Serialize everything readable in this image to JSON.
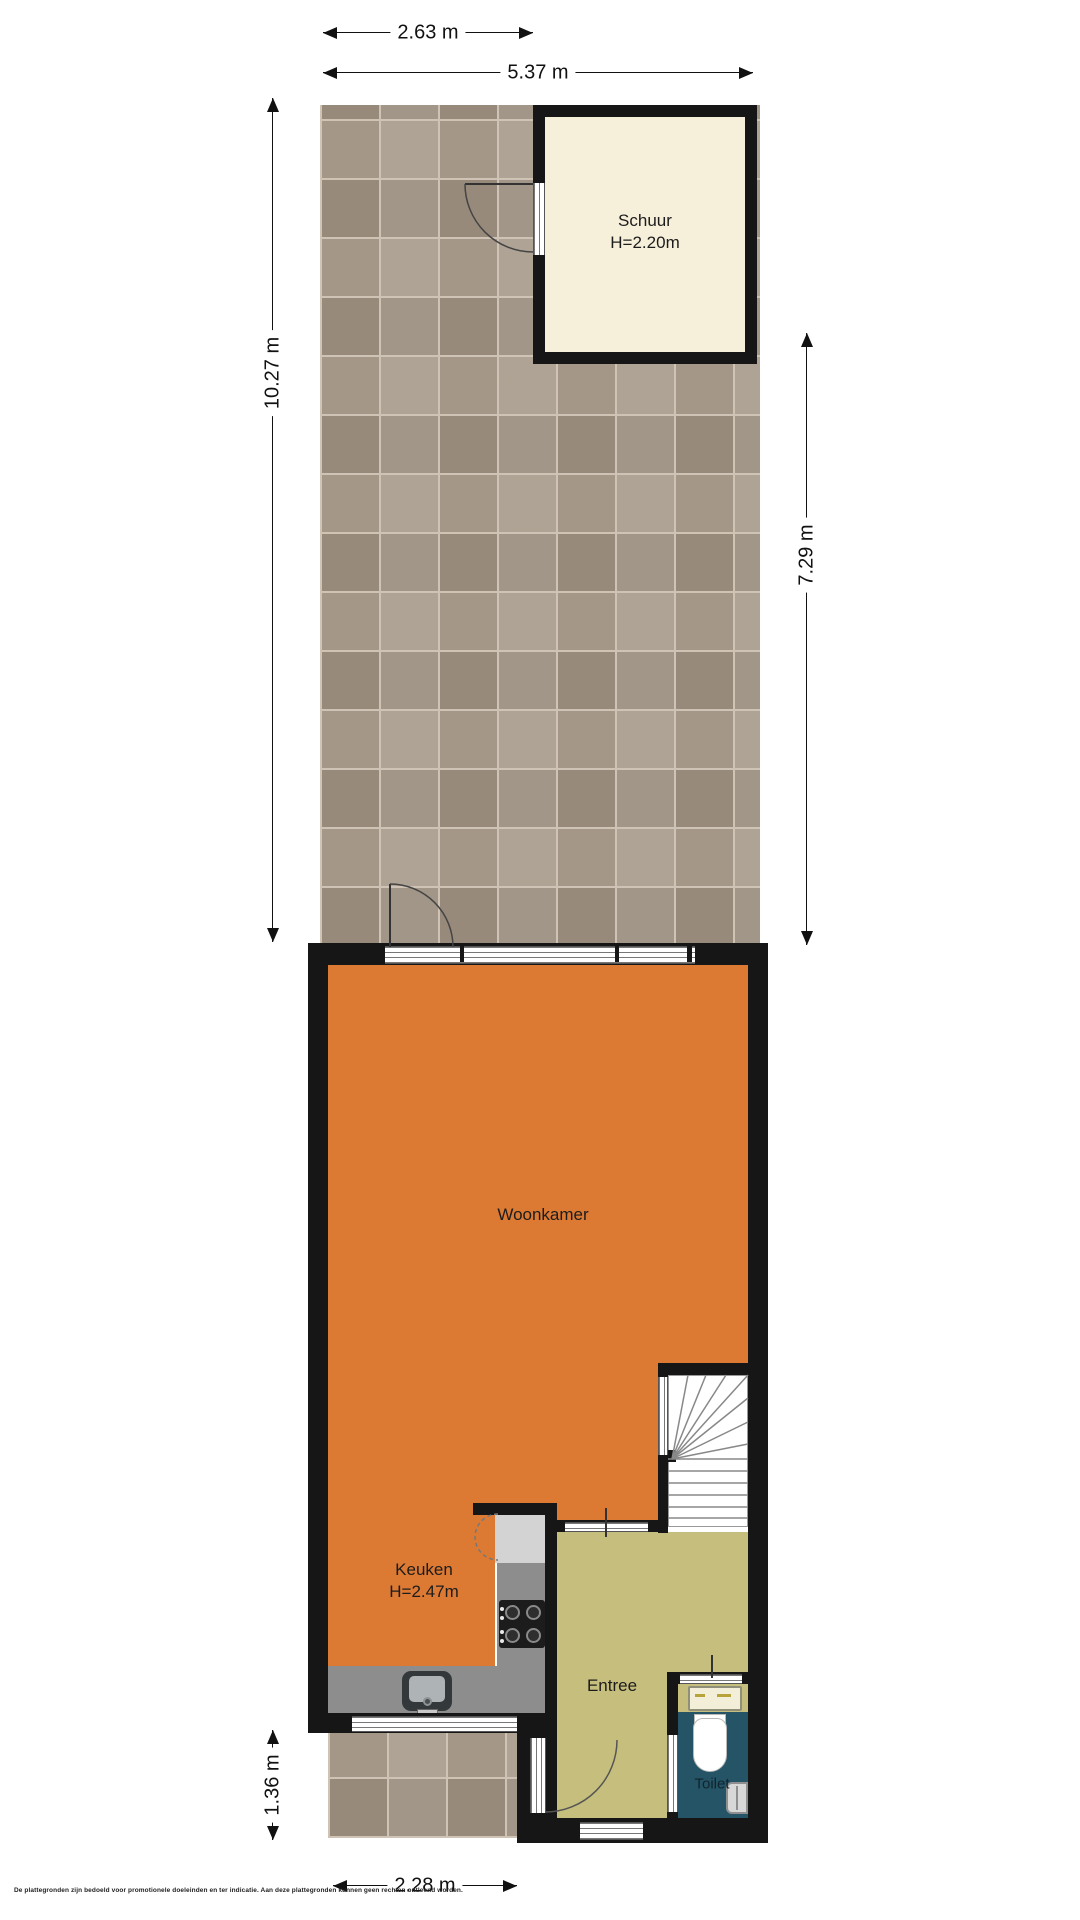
{
  "dimensions": {
    "top_inner": "2.63 m",
    "top_outer": "5.37 m",
    "left": "10.27 m",
    "right": "7.29 m",
    "bottom_left": "1.36 m",
    "bottom": "2.28 m"
  },
  "rooms": {
    "schuur": {
      "name": "Schuur",
      "height_note": "H=2.20m"
    },
    "woonkamer": {
      "name": "Woonkamer"
    },
    "keuken": {
      "name": "Keuken",
      "height_note": "H=2.47m"
    },
    "entree": {
      "name": "Entree"
    },
    "toilet": {
      "name": "Toilet"
    }
  },
  "colors": {
    "wall": "#161616",
    "woonkamer_floor": "#dc7a34",
    "entree_floor": "#c6be7c",
    "toilet_floor": "#245466",
    "schuur_floor": "#f6efda",
    "garden_tile": "#a69888",
    "tile_grout": "#cfc3b6",
    "counter": "#8d8d8d",
    "counter_light": "#d3d3d3",
    "stove": "#1c1c1c"
  },
  "footer": {
    "disclaimer": "De plattegronden zijn bedoeld voor promotionele doeleinden en ter indicatie. Aan deze plattegronden kunnen geen rechten ontleend worden."
  }
}
